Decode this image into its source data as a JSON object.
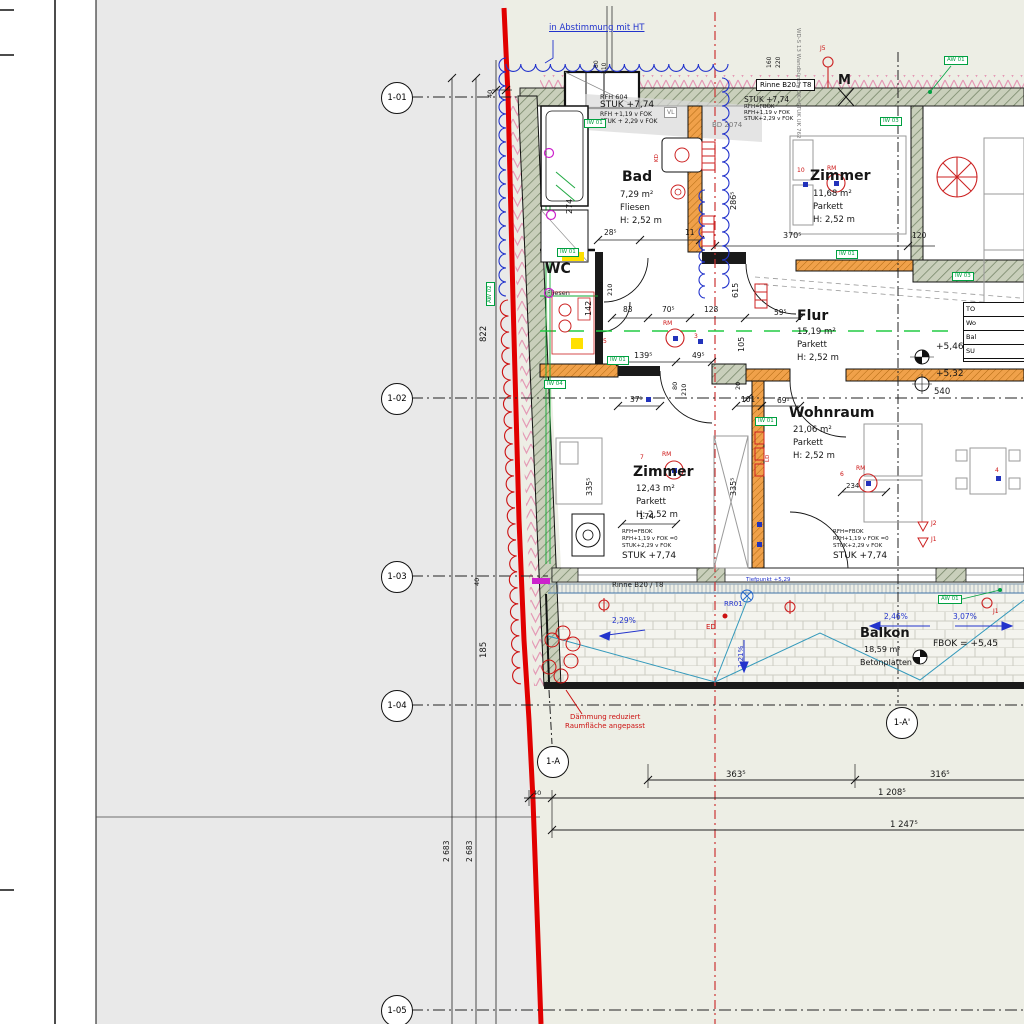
{
  "rooms": [
    {
      "name": "Bad",
      "area": "7,29 m²",
      "floor": "Fliesen",
      "height": "H: 2,52 m"
    },
    {
      "name": "WC",
      "floor": "Fliesen"
    },
    {
      "name": "Zimmer",
      "area": "11,68 m²",
      "floor": "Parkett",
      "height": "H: 2,52 m"
    },
    {
      "name": "Flur",
      "area": "15,19 m²",
      "floor": "Parkett",
      "height": "H: 2,52 m"
    },
    {
      "name": "Wohnraum",
      "area": "21,06 m²",
      "floor": "Parkett",
      "height": "H: 2,52 m"
    },
    {
      "name": "Zimmer",
      "area": "12,43 m²",
      "floor": "Parkett",
      "height": "H: 2,52 m"
    },
    {
      "name": "Balkon",
      "area": "18,59 m²",
      "floor": "Betonplatten",
      "fbok": "FBOK = +5,45"
    }
  ],
  "grid_bubbles": [
    "1-01",
    "1-02",
    "1-03",
    "1-04",
    "1-05",
    "1-A",
    "1-A'"
  ],
  "elevations": {
    "upper": "+5,46",
    "lower": "+5,32",
    "tiefpunkt": "Tiefpunkt +5,29"
  },
  "slopes": {
    "s1": "2,29%",
    "s2": "1,21%",
    "s3": "2,46%",
    "s4": "3,07%"
  },
  "annotations": {
    "abstimmung": "in Abstimmung mit HT",
    "daemmung1": "Dämmung reduziert",
    "daemmung2": "Raumfläche angepasst",
    "rinne_top": "Rinne B20 / T8",
    "rinne_bottom": "Rinne B20 / T8",
    "rr01": "RR01",
    "ed": "ED",
    "bd": "BD 2074",
    "vl": "VL",
    "m": "M",
    "wd": "WD-S 13 Wandbündig OK=STUK UK 762"
  },
  "stuk_top": {
    "l1": "RFH 604",
    "l2": "STUK +7,74",
    "l3": "RFH +1,19 v FOK",
    "l4": "STUK + 2,29 v FOK"
  },
  "stuk_right": {
    "l1": "STUK +7,74",
    "l2": "RFH=FBOK",
    "l3": "RFH+1,19 v FOK",
    "l4": "STUK+2,29 v FOK"
  },
  "stuk_bottom": {
    "l1": "RFH=FBOK",
    "l2": "RFH+1,19 v FOK =0",
    "l3": "STUK+2,29 v FOK",
    "l4": "STUK +7,74"
  },
  "wall_tags": {
    "t1": "IW 01",
    "t2": "AW 01",
    "t3": "IW 03",
    "t4": "IW 01",
    "t5": "IW 03",
    "t6": "IW 01",
    "t7": "IW 04",
    "t8": "IW 01",
    "t9": "AW 01",
    "t10": "IW 01",
    "t11": "AW 02"
  },
  "markers": {
    "rm": "RM",
    "kd": "KD",
    "ld": "LD",
    "j5": "J5",
    "j1": "J1",
    "j2": "J2",
    "n10": "10",
    "n3": "3",
    "n7": "7",
    "n6": "6",
    "n4": "4",
    "n5": "5"
  },
  "dims": {
    "b363": "363⁵",
    "b316": "316⁵",
    "b1208": "1 208⁵",
    "b1247": "1 247⁵",
    "b40": "40",
    "v822": "822",
    "v185": "185",
    "v40a": "40",
    "v40b": "40",
    "v2683a": "2 683",
    "v2683b": "2 683",
    "d274": "274",
    "d2865": "286⁵",
    "d615": "615",
    "d105": "105",
    "d142": "142",
    "d3355a": "335⁵",
    "d3355b": "335⁵",
    "d3705": "370⁵",
    "d120": "120",
    "d285": "28⁵",
    "d11": "11",
    "d83": "83",
    "d705": "70⁵",
    "d128": "128",
    "d595": "59⁵",
    "d1395": "139⁵",
    "d495": "49⁵",
    "d371": "37¹",
    "d101": "101",
    "d691": "69¹",
    "d540": "540",
    "d174": "174",
    "d234": "234",
    "d80a": "80",
    "d210a": "210",
    "d80b": "80",
    "d210b": "210",
    "d80c": "80",
    "d210c": "210",
    "d20": "20",
    "d160": "160",
    "d220": "220"
  },
  "summary_table": {
    "r1": "TO",
    "r2": "Wo",
    "r3": "Bal",
    "r4": "SU"
  },
  "colors": {
    "property_line": "#e10000",
    "insulation_blue": "#2233cc",
    "revision_red": "#cc1111",
    "tag_green": "#00a040",
    "section_green": "#22cc44",
    "wall_orange": "#f0a14a"
  }
}
